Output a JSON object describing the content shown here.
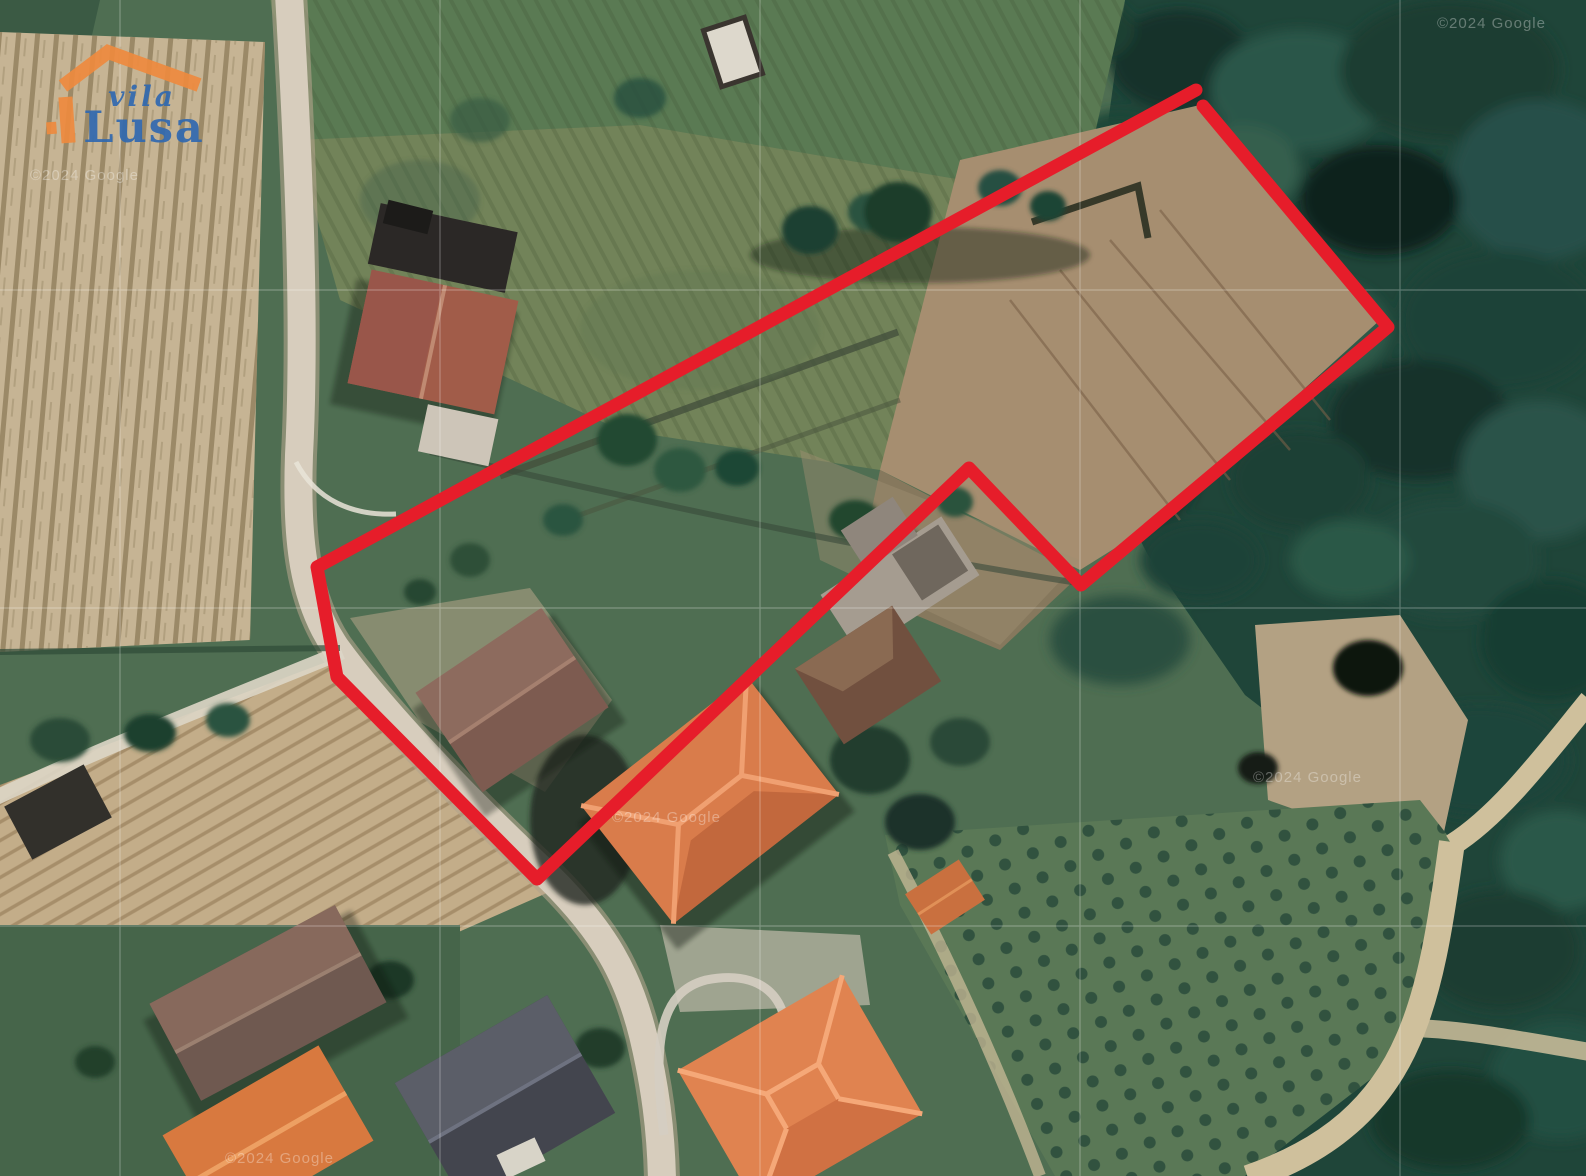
{
  "branding": {
    "logo_text_top": "vila",
    "logo_text_bottom": "Lusa",
    "orange": "#ee8a3e",
    "blue": "#3069b0"
  },
  "property_outline": {
    "color": "#e61d2a",
    "stroke_width": "13",
    "path": "M 1203,106 L 1388,327 L 1081,585 L 969,468 L 537,879 L 337,677 L 317,567 L 1196,90"
  },
  "watermarks": {
    "text": "©2024 Google"
  }
}
